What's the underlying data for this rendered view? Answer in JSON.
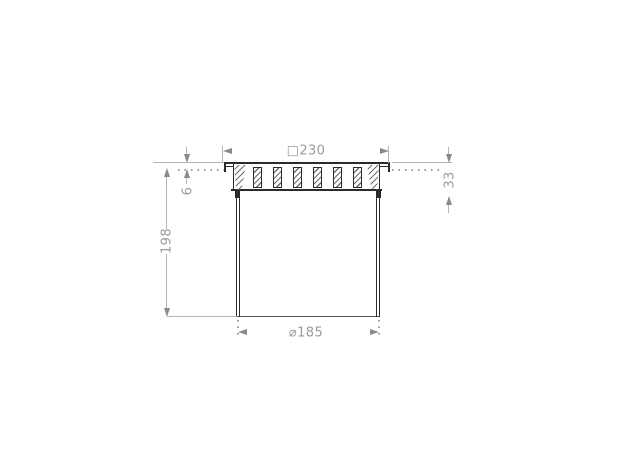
{
  "drawing": {
    "labels": {
      "frame_width": "□230",
      "flange_protrusion": "6",
      "frame_height": "33",
      "body_depth": "198",
      "body_diameter": "⌀185"
    },
    "grate": {
      "slat_count": 6,
      "slat_positions": [
        253,
        273,
        293,
        313,
        333,
        353
      ]
    },
    "colors": {
      "background": "#ffffff",
      "part_line": "#2b2b2b",
      "hatch": "#6e6e6e",
      "dim_line": "#b5b5b5",
      "dim_dot": "#9a9a9a",
      "dim_text": "#9b9b9b",
      "arrow": "#8a8a8a"
    }
  }
}
